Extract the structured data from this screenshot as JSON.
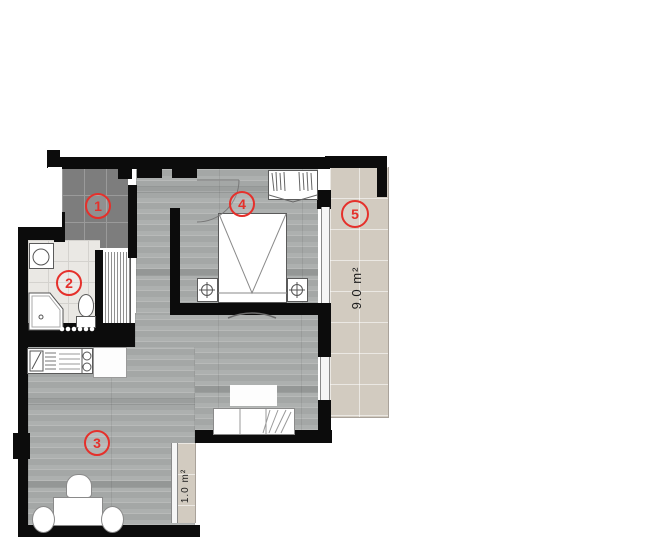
{
  "title": "apartment-floor-plan",
  "rooms": [
    {
      "number": "1",
      "name": "entrance-hall"
    },
    {
      "number": "2",
      "name": "bathroom"
    },
    {
      "number": "3",
      "name": "living-room-kitchen"
    },
    {
      "number": "4",
      "name": "bedroom"
    },
    {
      "number": "5",
      "name": "balcony"
    }
  ],
  "areas": {
    "balcony_large": "9.0 m²",
    "balcony_small": "1.0 m²"
  },
  "colors": {
    "wall": "#0c0c0c",
    "label_red": "#e5302b",
    "wood_floor": "#adb0af",
    "entry_tile": "#7d7d7d",
    "bath_tile": "#eae8e4",
    "balcony_tile": "#d2cbc0"
  }
}
